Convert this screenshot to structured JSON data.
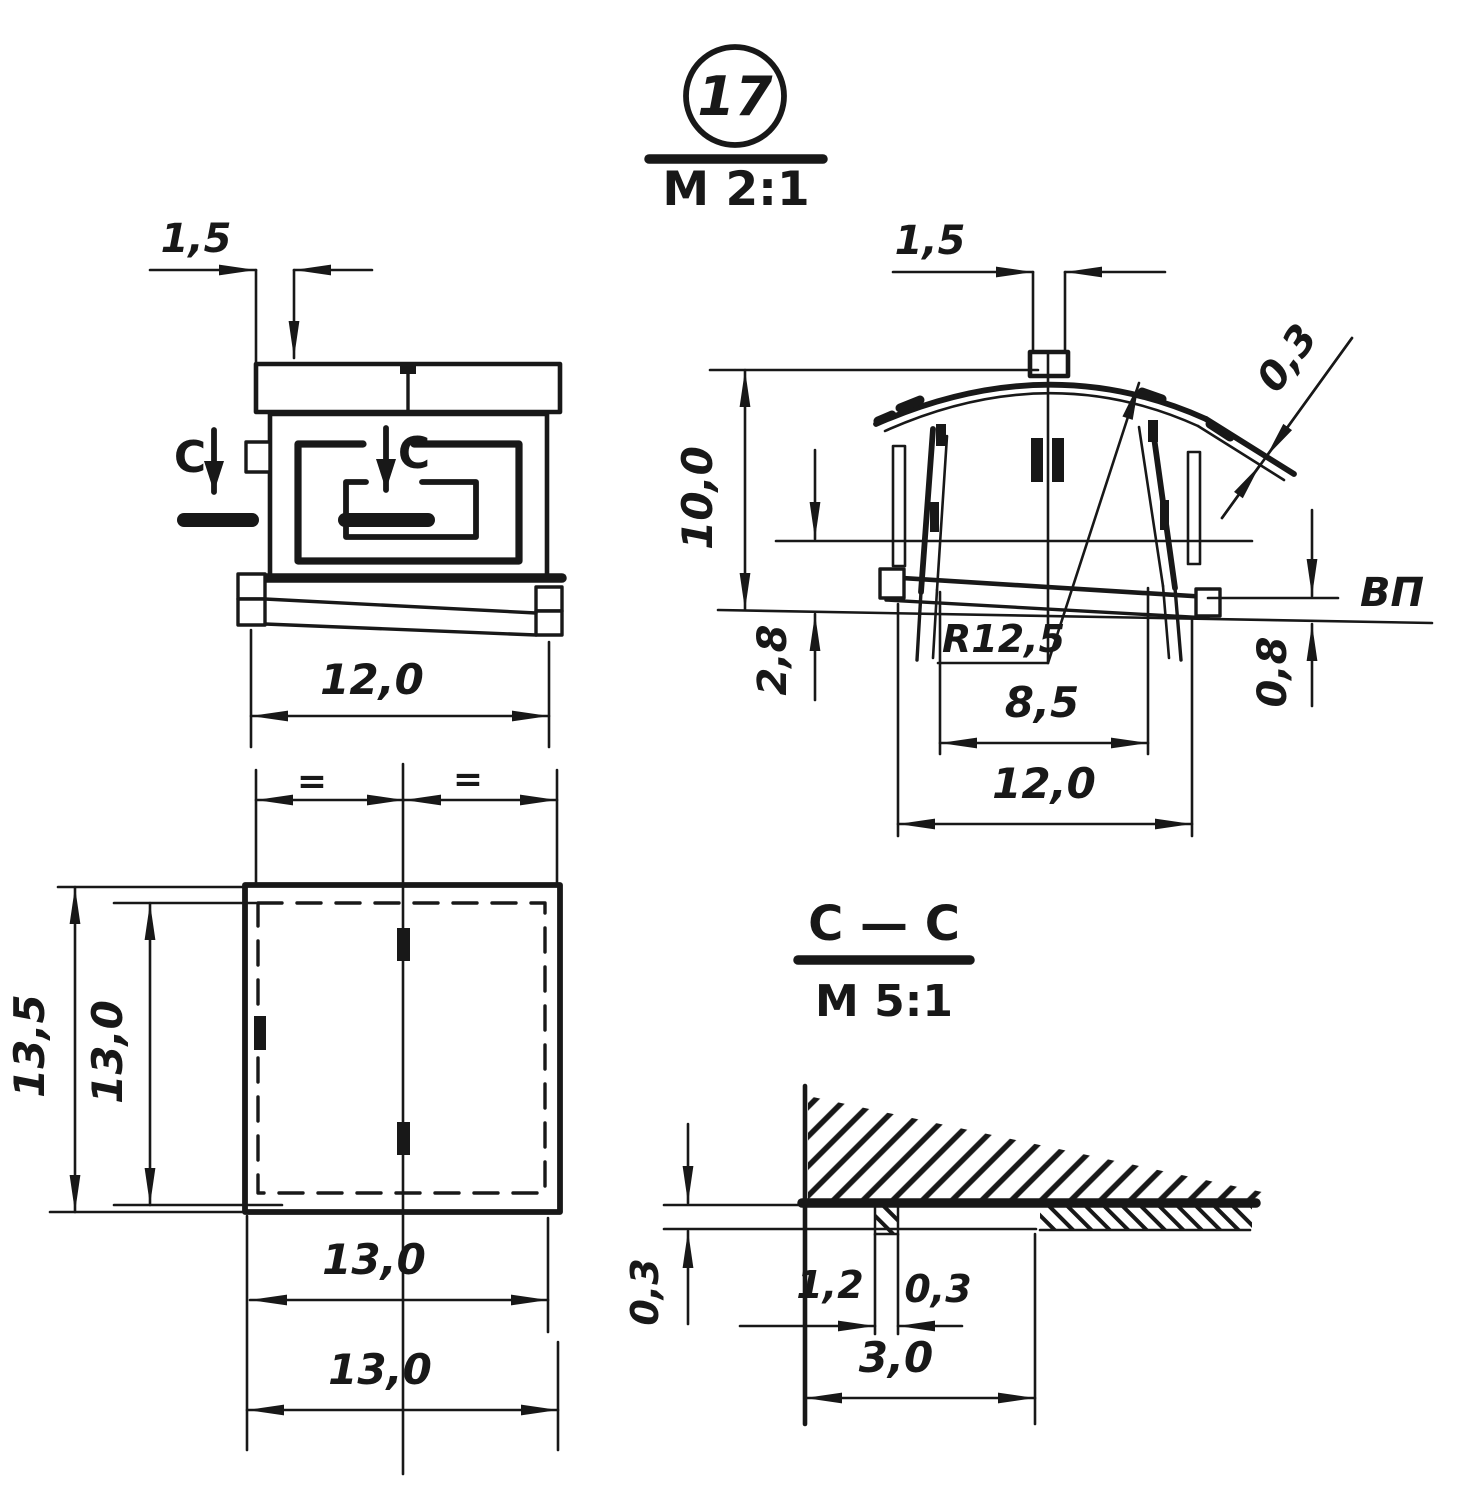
{
  "title": {
    "part_number": "17",
    "scale": "M 2:1"
  },
  "front_view": {
    "dim_tab_offset": "1,5",
    "dim_width": "12,0",
    "section_letter": "C"
  },
  "side_view": {
    "dim_tab_width": "1,5",
    "dim_height": "10,0",
    "dim_sheet_thickness": "0,3",
    "dim_mid_to_waterline": "2,8",
    "dim_skid_to_waterline": "0,8",
    "roof_radius": "R12,5",
    "dim_inner_width": "8,5",
    "dim_width": "12,0",
    "waterline_label": "ВП"
  },
  "plan_view": {
    "equal_mark_left": "=",
    "equal_mark_right": "=",
    "dim_outer_depth": "13,5",
    "dim_inner_depth": "13,0",
    "dim_width_inner": "13,0",
    "dim_width_outer": "13,0"
  },
  "section_view": {
    "title": "C — C",
    "scale": "M 5:1",
    "dim_wall_thickness": "0,3",
    "dim_rib_offset": "1,2",
    "dim_rib_thickness": "0,3",
    "dim_width": "3,0"
  }
}
